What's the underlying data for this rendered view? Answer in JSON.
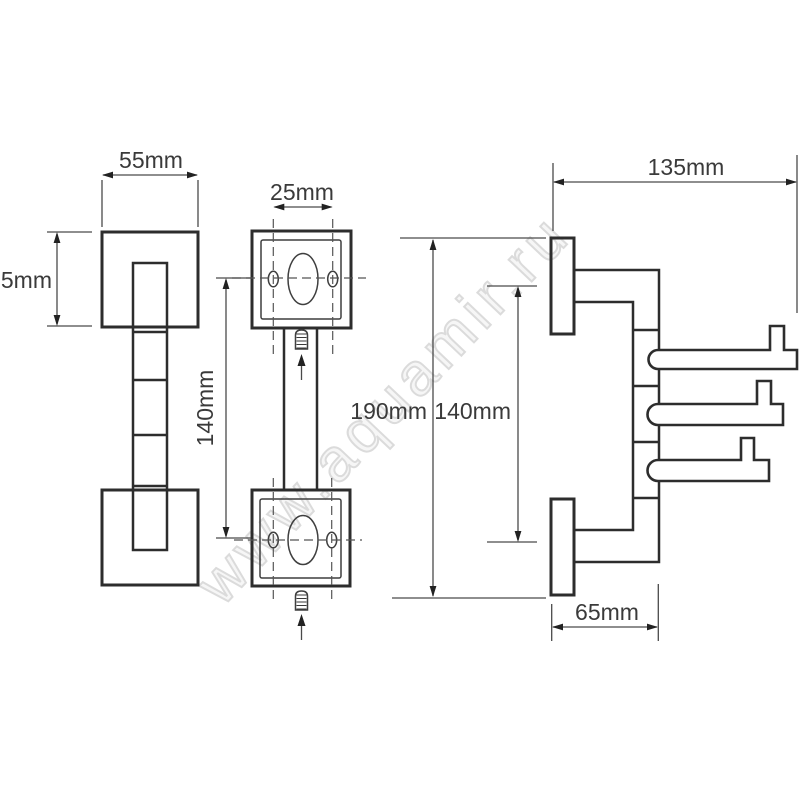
{
  "watermark": {
    "text": "www.aquamir.ru"
  },
  "colors": {
    "object_line": "#2d2d2d",
    "dimension_line": "#4a4a4a",
    "label_text": "#3a3a3a",
    "watermark": "#dbdbdb",
    "background": "#ffffff"
  },
  "front_view": {
    "width": "55mm",
    "height": "55mm"
  },
  "plate_view": {
    "hole_spacing": "25mm",
    "plate_spacing": "140mm"
  },
  "side_view": {
    "overall_height": "190mm",
    "hook_span": "140mm",
    "reach": "135mm",
    "depth": "65mm"
  }
}
